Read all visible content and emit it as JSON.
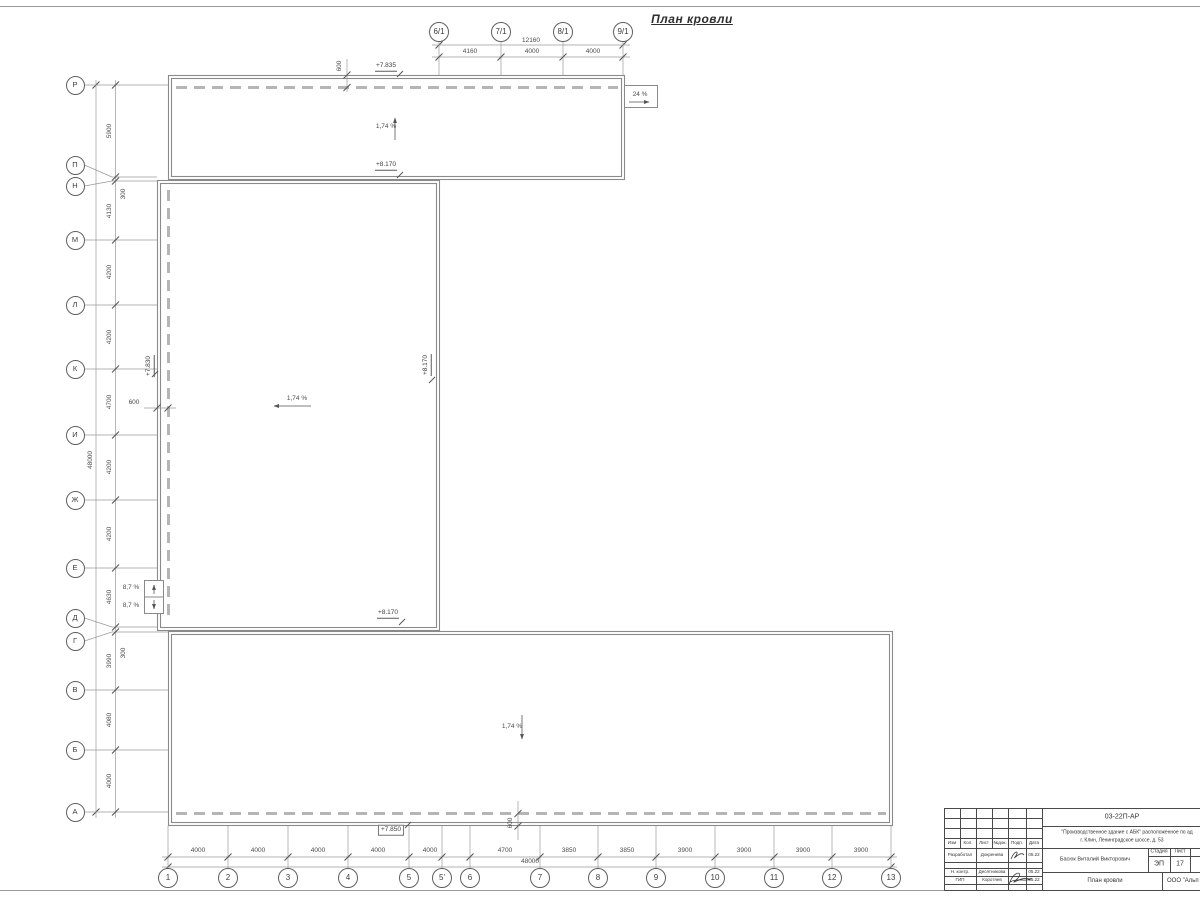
{
  "sheet": {
    "title": "План кровли"
  },
  "drawing": {
    "left_axes": [
      {
        "label": "Р",
        "cy": 85,
        "x2": 168
      },
      {
        "label": "П",
        "cy": 165,
        "gy": 177,
        "x2": 157
      },
      {
        "label": "Н",
        "cy": 186,
        "gy": 181,
        "x2": 157
      },
      {
        "label": "М",
        "cy": 240,
        "x2": 157
      },
      {
        "label": "Л",
        "cy": 305,
        "x2": 157
      },
      {
        "label": "К",
        "cy": 369,
        "x2": 157
      },
      {
        "label": "И",
        "cy": 435,
        "x2": 157
      },
      {
        "label": "Ж",
        "cy": 500,
        "x2": 157
      },
      {
        "label": "Е",
        "cy": 568,
        "x2": 157
      },
      {
        "label": "Д",
        "cy": 618,
        "gy": 627,
        "x2": 157
      },
      {
        "label": "Г",
        "cy": 641,
        "gy": 632,
        "x2": 168
      },
      {
        "label": "В",
        "cy": 690,
        "x2": 168
      },
      {
        "label": "Б",
        "cy": 750,
        "x2": 168
      },
      {
        "label": "А",
        "cy": 812,
        "x2": 168
      }
    ],
    "top_axes": [
      {
        "label": "6/1",
        "x": 439
      },
      {
        "label": "7/1",
        "x": 501
      },
      {
        "label": "8/1",
        "x": 563
      },
      {
        "label": "9/1",
        "x": 623
      }
    ],
    "bottom_axes": [
      {
        "label": "1",
        "x": 168
      },
      {
        "label": "2",
        "x": 228
      },
      {
        "label": "3",
        "x": 288
      },
      {
        "label": "4",
        "x": 348
      },
      {
        "label": "5",
        "x": 409
      },
      {
        "label": "5'",
        "x": 442
      },
      {
        "label": "6",
        "x": 470
      },
      {
        "label": "7",
        "x": 540
      },
      {
        "label": "8",
        "x": 598
      },
      {
        "label": "9",
        "x": 656
      },
      {
        "label": "10",
        "x": 715
      },
      {
        "label": "11",
        "x": 774
      },
      {
        "label": "12",
        "x": 832
      },
      {
        "label": "13",
        "x": 891
      }
    ],
    "dim_labels": [
      {
        "t": "4160",
        "x": 470,
        "y": 52
      },
      {
        "t": "4000",
        "x": 532,
        "y": 52
      },
      {
        "t": "4000",
        "x": 593,
        "y": 52
      },
      {
        "t": "12160",
        "x": 531,
        "y": 41
      },
      {
        "t": "5900",
        "x": 110,
        "y": 131,
        "r": 1
      },
      {
        "t": "300",
        "x": 124,
        "y": 194,
        "r": 1
      },
      {
        "t": "4130",
        "x": 110,
        "y": 211,
        "r": 1
      },
      {
        "t": "4200",
        "x": 110,
        "y": 272,
        "r": 1
      },
      {
        "t": "4200",
        "x": 110,
        "y": 337,
        "r": 1
      },
      {
        "t": "4700",
        "x": 110,
        "y": 402,
        "r": 1
      },
      {
        "t": "4200",
        "x": 110,
        "y": 467,
        "r": 1
      },
      {
        "t": "4200",
        "x": 110,
        "y": 534,
        "r": 1
      },
      {
        "t": "4630",
        "x": 110,
        "y": 597,
        "r": 1
      },
      {
        "t": "300",
        "x": 124,
        "y": 653,
        "r": 1
      },
      {
        "t": "3990",
        "x": 110,
        "y": 661,
        "r": 1
      },
      {
        "t": "4080",
        "x": 110,
        "y": 720,
        "r": 1
      },
      {
        "t": "4000",
        "x": 110,
        "y": 781,
        "r": 1
      },
      {
        "t": "48000",
        "x": 91,
        "y": 460,
        "r": 1
      },
      {
        "t": "4000",
        "x": 198,
        "y": 851
      },
      {
        "t": "4000",
        "x": 258,
        "y": 851
      },
      {
        "t": "4000",
        "x": 318,
        "y": 851
      },
      {
        "t": "4000",
        "x": 378,
        "y": 851
      },
      {
        "t": "4000",
        "x": 430,
        "y": 851
      },
      {
        "t": "4700",
        "x": 505,
        "y": 851
      },
      {
        "t": "3850",
        "x": 569,
        "y": 851
      },
      {
        "t": "3850",
        "x": 627,
        "y": 851
      },
      {
        "t": "3900",
        "x": 685,
        "y": 851
      },
      {
        "t": "3900",
        "x": 744,
        "y": 851
      },
      {
        "t": "3900",
        "x": 803,
        "y": 851
      },
      {
        "t": "3900",
        "x": 861,
        "y": 851
      },
      {
        "t": "48000",
        "x": 530,
        "y": 862
      },
      {
        "t": "600",
        "x": 340,
        "y": 66,
        "r": 1
      },
      {
        "t": "600",
        "x": 134,
        "y": 403
      },
      {
        "t": "600",
        "x": 511,
        "y": 823,
        "r": 1
      }
    ],
    "elevations": [
      {
        "t": "+7.835",
        "x": 386,
        "y": 67
      },
      {
        "t": "+8.170",
        "x": 386,
        "y": 166
      },
      {
        "t": "+7.830",
        "x": 150,
        "y": 366,
        "r": 1
      },
      {
        "t": "+8.170",
        "x": 427,
        "y": 365,
        "r": 1
      },
      {
        "t": "+8.170",
        "x": 388,
        "y": 614
      },
      {
        "t": "+7.850",
        "x": 391,
        "y": 830,
        "b": 1
      }
    ],
    "slopes": [
      {
        "t": "1,74 %",
        "x": 386,
        "y": 127
      },
      {
        "t": "1,74 %",
        "x": 297,
        "y": 399
      },
      {
        "t": "1,74 %",
        "x": 512,
        "y": 727
      },
      {
        "t": "24 %",
        "x": 640,
        "y": 95
      },
      {
        "t": "8,7 %",
        "x": 131,
        "y": 588
      },
      {
        "t": "8,7 %",
        "x": 131,
        "y": 606
      }
    ]
  },
  "title_block": {
    "code": "03-22П-АР",
    "project_line1": "\"Производственное здание с АБК\" расположенное по ад",
    "project_line2": "г. Клин, Ленинградское шоссе, д. 53",
    "author": "Басюк Виталий Викторович",
    "stage_label": "Стадия",
    "sheet_label": "Лист",
    "stage": "ЭП",
    "sheet_no": "17",
    "doc_title": "План кровли",
    "company": "ООО \"Альп",
    "cols": [
      "Изм",
      "Кол.",
      "Лист",
      "№док.",
      "Подп.",
      "Дата"
    ],
    "rows": [
      {
        "role": "Разработал",
        "name": "Докренева",
        "date": "05.22"
      },
      {
        "role": "Н. контр.",
        "name": "Десятникова",
        "date": "05.22"
      },
      {
        "role": "ГИП",
        "name": "Коротяев",
        "date": "05.22"
      }
    ]
  }
}
